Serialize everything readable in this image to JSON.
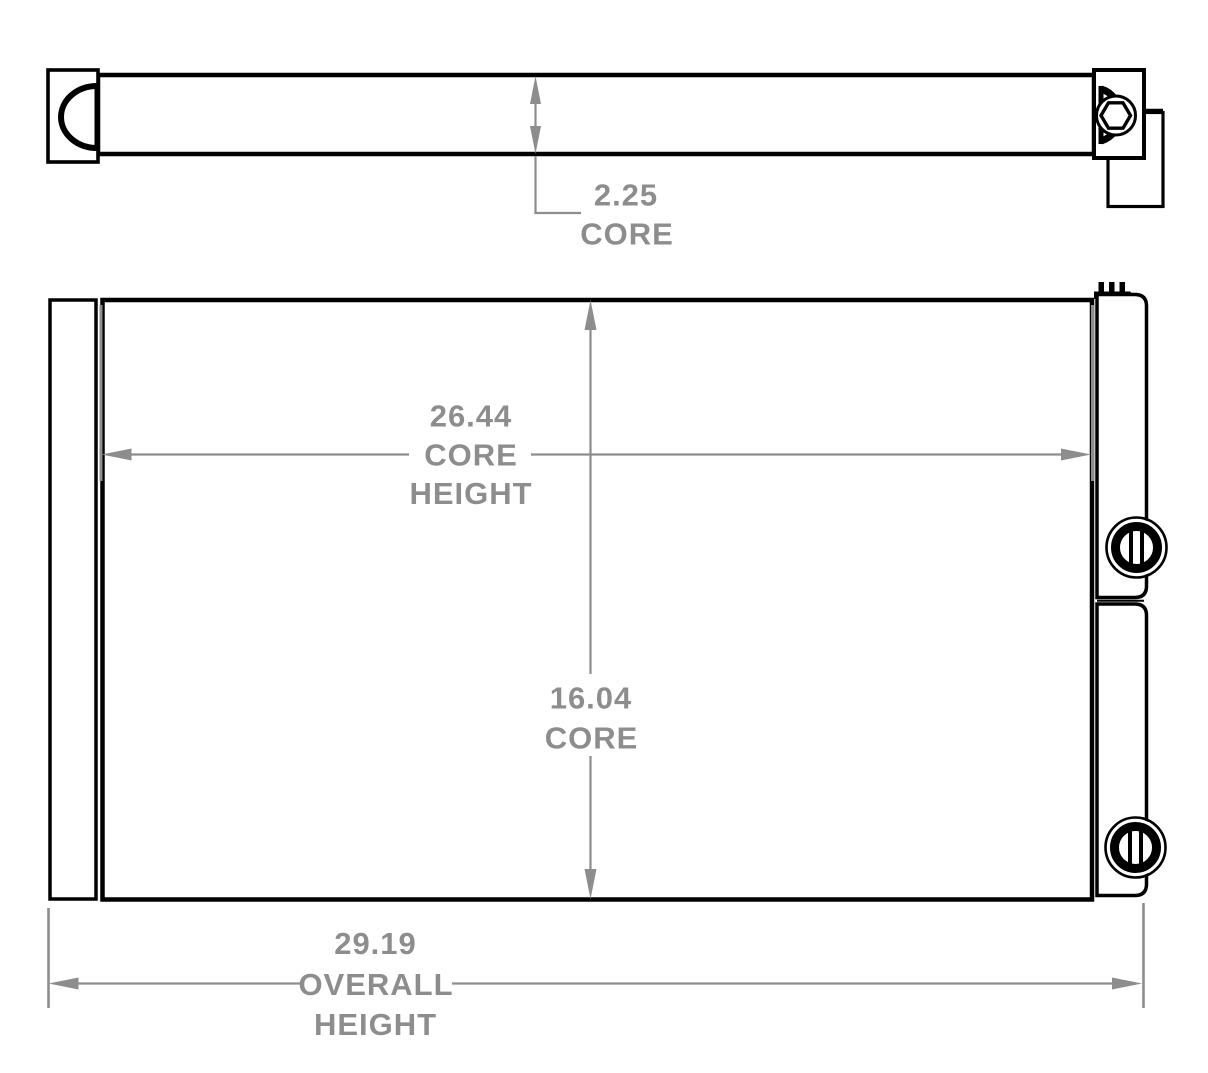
{
  "colors": {
    "outline": "#000000",
    "dimension": "#8d8d8d",
    "background": "#ffffff"
  },
  "dimensions": {
    "core_depth": {
      "value": "2.25",
      "label": "CORE"
    },
    "core_width": {
      "value": "26.44",
      "label_line1": "CORE",
      "label_line2": "HEIGHT"
    },
    "core_height": {
      "value": "16.04",
      "label": "CORE"
    },
    "overall_height": {
      "value": "29.19",
      "label_line1": "OVERALL",
      "label_line2": "HEIGHT"
    }
  }
}
